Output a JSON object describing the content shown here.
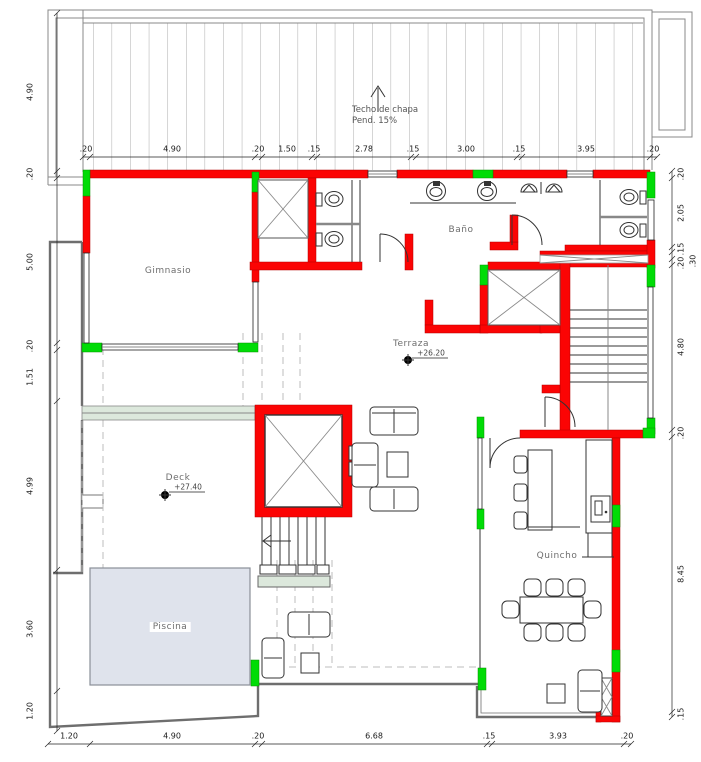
{
  "title": "Planta - nivel terraza",
  "rooms": {
    "gimnasio": "Gimnasio",
    "bano": "Baño",
    "terraza": "Terraza",
    "deck": "Deck",
    "piscina": "Piscina",
    "quincho": "Quincho"
  },
  "levels": {
    "terraza": "+26.20",
    "deck": "+27.40"
  },
  "roof_note": {
    "line1": "Techo de chapa",
    "line2": "Pend. 15%"
  },
  "dims": {
    "top": [
      ".20",
      "4.90",
      ".20",
      "1.50",
      ".15",
      "2.78",
      ".15",
      "3.00",
      ".15",
      "3.95",
      ".20"
    ],
    "bottom": [
      "1.20",
      "4.90",
      ".20",
      "6.68",
      ".15",
      "3.93",
      ".20"
    ],
    "left": [
      "4.90",
      ".20",
      "5.00",
      ".20",
      "1.51",
      "4.99",
      "3.60",
      "1.20"
    ],
    "right": [
      ".20",
      "2.05",
      ".15",
      ".20",
      ".30",
      "4.80",
      ".20",
      "8.45",
      ".15"
    ]
  },
  "colors": {
    "wall": "#fb0404",
    "column": "#00dc06",
    "pool": "#dfe3ec",
    "band": "#dce8dc",
    "hatch": "#ababab",
    "boundary": "#6e6e6e"
  }
}
